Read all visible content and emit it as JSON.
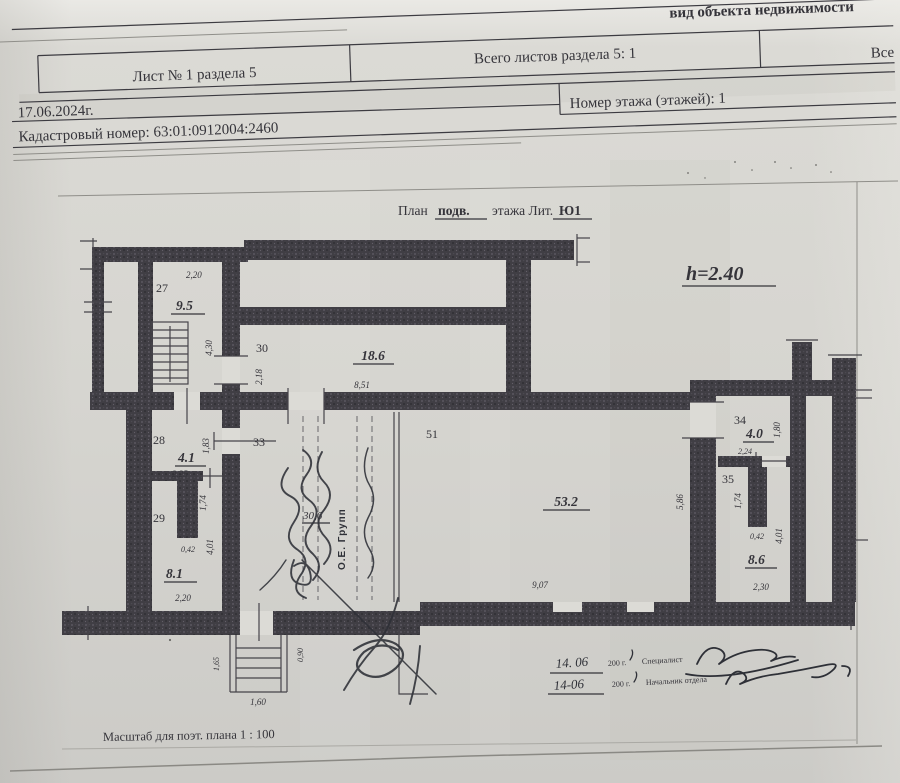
{
  "document": {
    "top_label": "вид объекта недвижимости",
    "header_table": {
      "sheet_cell": "Лист № 1 раздела 5",
      "total_sheets_cell": "Всего листов раздела 5: 1",
      "right_cell_truncated": "Все",
      "survey_date": "17.06.2024г.",
      "floor_number_cell": "Номер этажа (этажей): 1",
      "cadastral_number": "Кадастровый номер: 63:01:0912004:2460"
    }
  },
  "plan": {
    "title": {
      "prefix": "План",
      "floor_type": "подв.",
      "middle": "этажа Лит.",
      "liter": "Ю1"
    },
    "ceiling_height": "h=2.40",
    "scale_note": "Масштаб для поэт. плана 1 : 100",
    "rooms": {
      "r27": {
        "num": "27",
        "area": "9.5",
        "d_top": "2,20",
        "d_right": "4,30"
      },
      "r30": {
        "num": "30",
        "area": "18.6",
        "d_left": "2,18",
        "d_bottom": "8,51"
      },
      "r28": {
        "num": "28",
        "area": "4.1",
        "d_bottom": "2,25",
        "d_door": "1,83"
      },
      "r33": {
        "num": "33"
      },
      "r29": {
        "num": "29",
        "area": "8.1",
        "d_stub": "1,74",
        "d_stub_w": "0,42",
        "d_right": "4,01",
        "d_bottom": "2,20"
      },
      "r_center": {
        "area": "30,6"
      },
      "r51": {
        "num": "51",
        "area": "53.2",
        "d_bottom": "9,07",
        "d_right": "5,86"
      },
      "r34": {
        "num": "34",
        "area": "4.0",
        "d_bottom": "2,24",
        "d_right": "1,80"
      },
      "r35": {
        "num": "35",
        "area": "8.6",
        "d_stub": "1,74",
        "d_stub_w": "0,42",
        "d_right": "4,01",
        "d_bottom": "2,30"
      }
    },
    "exterior_stair": {
      "d_left": "1,65",
      "d_bottom": "1,60",
      "d_opening": "0,90"
    }
  },
  "annotations": {
    "stamp_vertical": "О.Е. Групп",
    "sign_row1": {
      "date": "14. 06",
      "year": "200  г.",
      "role": "Специалист"
    },
    "sign_row2": {
      "date": "14-06",
      "year": "200  г.",
      "role": "Начальник отдела"
    }
  },
  "colors": {
    "paper": "#d7d6d1",
    "ink": "#35343a",
    "wall_fill": "#403e44",
    "handwriting": "#2e3037"
  }
}
